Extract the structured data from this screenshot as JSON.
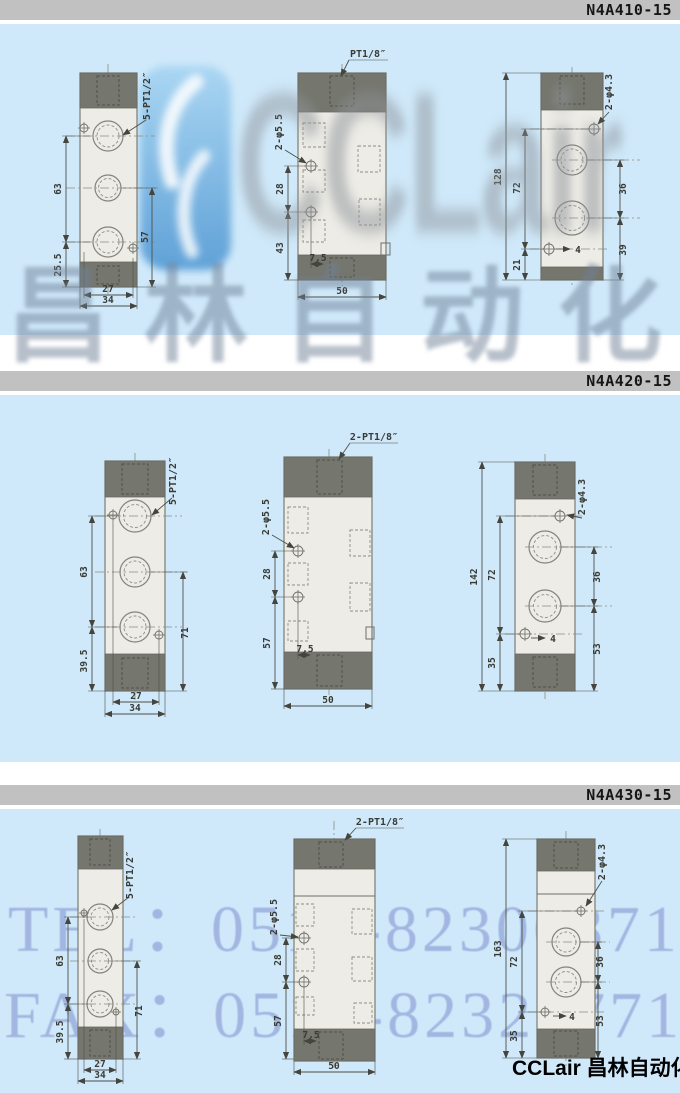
{
  "sections": [
    {
      "model": "N4A410-15",
      "front": {
        "port": "5-PT1/2″",
        "a": "63",
        "b": "25.5",
        "c": "57",
        "w1": "27",
        "w2": "34"
      },
      "side": {
        "port": "PT1/8″",
        "hole": "2-φ5.5",
        "a": "28",
        "b": "43",
        "off": "7.5",
        "w": "50"
      },
      "back": {
        "hole": "2-φ4.3",
        "total": "128",
        "a": "72",
        "b": "21",
        "r1": "36",
        "r2": "39",
        "off": "4"
      }
    },
    {
      "model": "N4A420-15",
      "front": {
        "port": "5-PT1/2″",
        "a": "63",
        "b": "39.5",
        "c": "71",
        "w1": "27",
        "w2": "34"
      },
      "side": {
        "port": "2-PT1/8″",
        "hole": "2-φ5.5",
        "a": "28",
        "b": "57",
        "off": "7.5",
        "w": "50"
      },
      "back": {
        "hole": "2-φ4.3",
        "total": "142",
        "a": "72",
        "b": "35",
        "r1": "36",
        "r2": "53",
        "off": "4"
      }
    },
    {
      "model": "N4A430-15",
      "front": {
        "port": "5-PT1/2″",
        "a": "63",
        "b": "39.5",
        "c": "71",
        "w1": "27",
        "w2": "34"
      },
      "side": {
        "port": "2-PT1/8″",
        "hole": "2-φ5.5",
        "a": "28",
        "b": "57",
        "off": "7.5",
        "w": "50"
      },
      "back": {
        "hole": "2-φ4.3",
        "total": "163",
        "a": "72",
        "b": "35",
        "r1": "36",
        "r2": "53",
        "off": "4"
      }
    }
  ],
  "watermarks": {
    "logo": "CCLair",
    "cn": "昌林自动化",
    "tel": "TEL：0510-82306871",
    "fax": "FAX：0510-82328771",
    "footer": "CCLair 昌林自动化"
  },
  "colors": {
    "panel_blue": "#cfe9fa",
    "bar_gray": "#c1c1c1",
    "body_fill": "#edece6",
    "band_fill": "#75766d",
    "dim_line": "#4e4f48",
    "watermark_periwinkle": "#9cb0de",
    "logo_badge_blue": "#7db9e8",
    "logo_gray": "#8e939a"
  }
}
